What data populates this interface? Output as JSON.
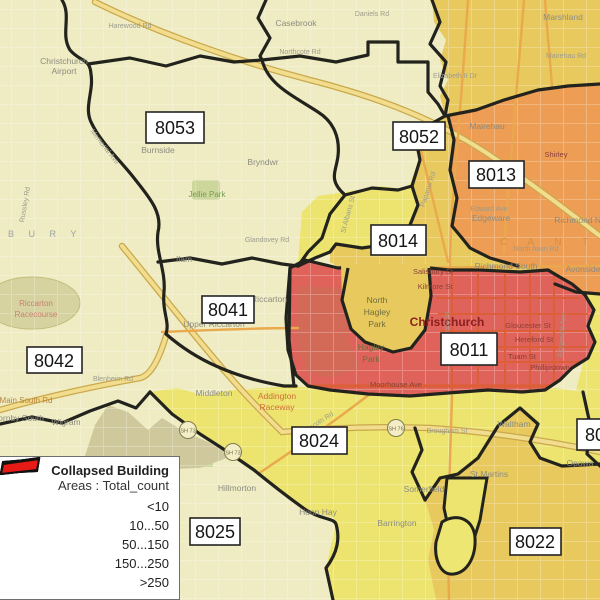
{
  "colors": {
    "base": "#efecc3",
    "class_yellow": "#ece46f",
    "class_gold": "#e8c95e",
    "class_orange": "#ed9d54",
    "class_red": "#df635a",
    "boundary": "#23231d",
    "highway_fill": "#f2dd8e",
    "highway_edge": "#c9a84c",
    "road_orange": "#e9a94c",
    "road_red": "#dd5f38",
    "park_green": "#cdd69b",
    "park_olive": "#d6d3a0",
    "airfield": "#cfc89c",
    "enclave": "#ede672"
  },
  "legend": {
    "title": "Collapsed Building",
    "subtitle": "Areas : Total_count",
    "items": [
      {
        "label": "<10",
        "color": "#f7f3c1"
      },
      {
        "label": "10...50",
        "color": "#f3e628"
      },
      {
        "label": "50...150",
        "color": "#f4b32c"
      },
      {
        "label": "150...250",
        "color": "#f1861d"
      },
      {
        "label": ">250",
        "color": "#e71a15"
      }
    ]
  },
  "zone_labels": [
    {
      "label": "8053"
    },
    {
      "label": "8052"
    },
    {
      "label": "8013"
    },
    {
      "label": "8014"
    },
    {
      "label": "8041"
    },
    {
      "label": "8042"
    },
    {
      "label": "8011"
    },
    {
      "label": "8024"
    },
    {
      "label": "8025"
    },
    {
      "label": "8022"
    },
    {
      "label": "80"
    }
  ],
  "shields": [
    {
      "label": "SH 73"
    },
    {
      "label": "SH 73"
    },
    {
      "label": "SH 76"
    }
  ],
  "places": [
    {
      "text": "Christchurch"
    },
    {
      "text": "Christchurch"
    },
    {
      "text": "Airport"
    },
    {
      "text": "Casebrook"
    },
    {
      "text": "Northcote Rd"
    },
    {
      "text": "Harewood Rd"
    },
    {
      "text": "Marshland"
    },
    {
      "text": "Mairehau"
    },
    {
      "text": "Shirley"
    },
    {
      "text": "Richmond North"
    },
    {
      "text": "North Avon Rd"
    },
    {
      "text": "Richmond South"
    },
    {
      "text": "Avonside"
    },
    {
      "text": "Edgeware"
    },
    {
      "text": "Burnside"
    },
    {
      "text": "Bryndwr"
    },
    {
      "text": "Jellie Park"
    },
    {
      "text": "Riccarton"
    },
    {
      "text": "Upper Riccarton"
    },
    {
      "text": "Riccarton"
    },
    {
      "text": "Racecourse"
    },
    {
      "text": "Middleton"
    },
    {
      "text": "Addington"
    },
    {
      "text": "Raceway"
    },
    {
      "text": "Hillmorton"
    },
    {
      "text": "Hoon Hay"
    },
    {
      "text": "Barrington"
    },
    {
      "text": "Somerfield"
    },
    {
      "text": "Waltham"
    },
    {
      "text": "Brougham St"
    },
    {
      "text": "St Martins"
    },
    {
      "text": "North"
    },
    {
      "text": "Hagley"
    },
    {
      "text": "Park"
    },
    {
      "text": "Hagley"
    },
    {
      "text": "Park"
    },
    {
      "text": "Gloucester St"
    },
    {
      "text": "Hereford St"
    },
    {
      "text": "Tuam St"
    },
    {
      "text": "Phillipstown"
    },
    {
      "text": "Moorhouse Ave"
    },
    {
      "text": "Salisbury St"
    },
    {
      "text": "Kilmore St"
    },
    {
      "text": "Main South Rd"
    },
    {
      "text": "Hornby South"
    },
    {
      "text": "Wigram"
    },
    {
      "text": "Blenheim Rd"
    },
    {
      "text": "Ilam"
    },
    {
      "text": "Glandovey Rd"
    },
    {
      "text": "Daniels Rd"
    },
    {
      "text": "Elizabeth II Dr"
    },
    {
      "text": "Mairehau Rd"
    },
    {
      "text": "Edward Ave"
    },
    {
      "text": "C A N T E"
    },
    {
      "text": "B U R Y"
    },
    {
      "text": "Opawa"
    },
    {
      "text": "Memorial Ave"
    },
    {
      "text": "Papanui Rd"
    },
    {
      "text": "Lincoln Rd"
    },
    {
      "text": "Colombo St"
    },
    {
      "text": "Fitzgerald Ave"
    },
    {
      "text": "Russley Rd"
    },
    {
      "text": "St Albans St"
    }
  ]
}
